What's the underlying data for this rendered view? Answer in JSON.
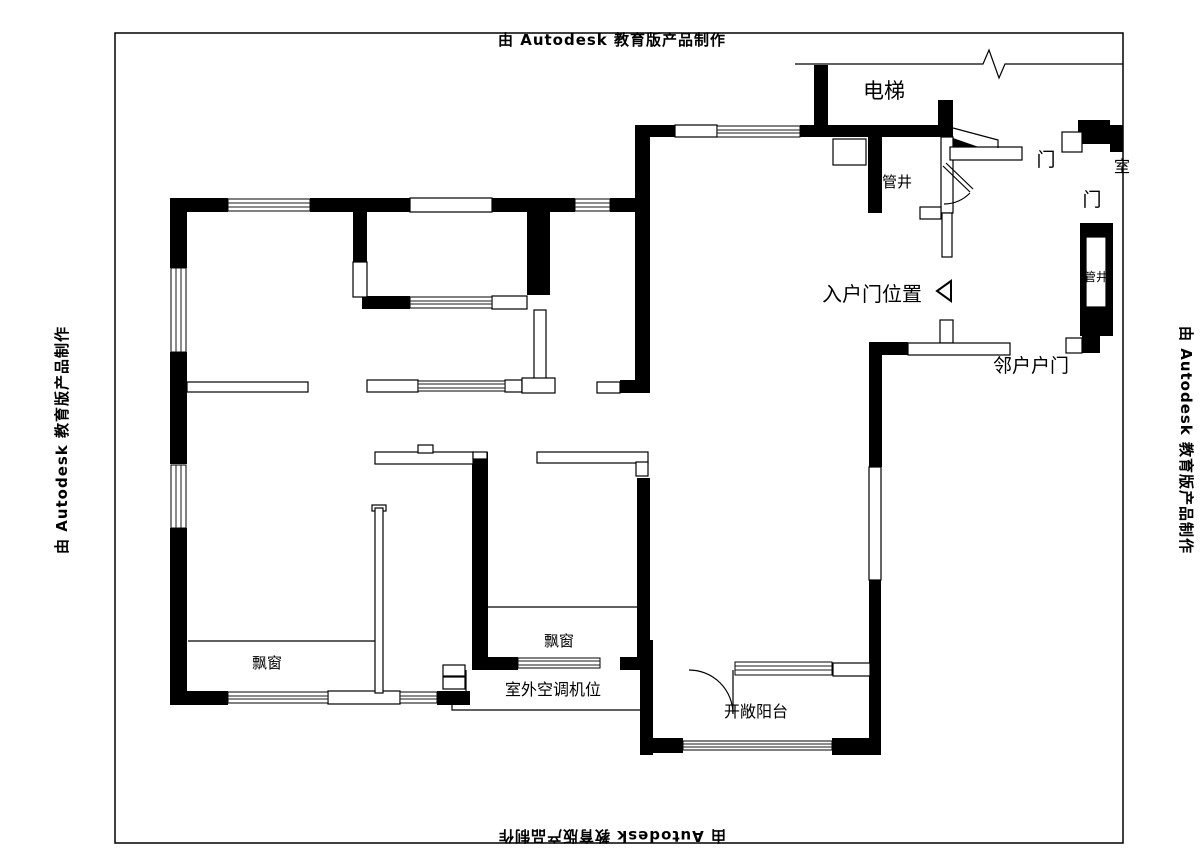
{
  "watermark": {
    "text": "由 Autodesk 教育版产品制作"
  },
  "plan_labels": {
    "elevator": "电梯",
    "pipe_shaft_top": "管井",
    "pipe_shaft_right": "管井",
    "door_top": "门",
    "door_right": "门",
    "room_label_clipped": "室",
    "entry_door_position": "入户门位置",
    "neighbor_entry_door": "邻户户门",
    "bay_window_left": "飘窗",
    "bay_window_middle": "飘窗",
    "outdoor_ac_unit": "室外空调机位",
    "open_balcony": "开敞阳台"
  },
  "colors": {
    "wall": "#000000",
    "background": "#ffffff",
    "line": "#000000"
  }
}
